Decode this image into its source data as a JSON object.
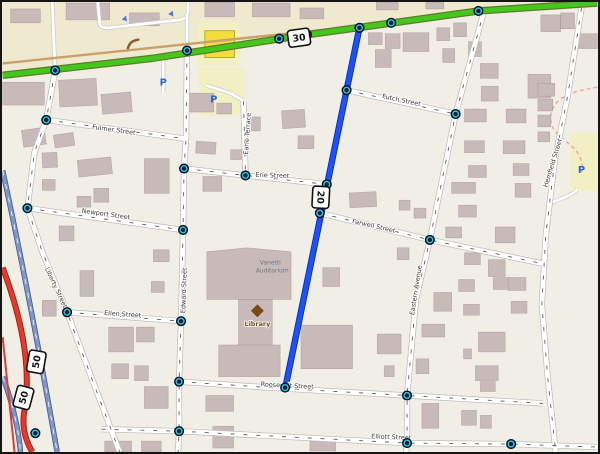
{
  "map": {
    "background": {
      "base": "#f1eee6",
      "upper_band": "#efe9cf"
    },
    "colors": {
      "building": "#c9baba",
      "building_stroke": "#9a8484",
      "road_fill": "#ffffff",
      "road_casing": "#b9b9b9",
      "road_dash": "#5a5a5a",
      "highway_green": "#43c71c",
      "highway_green_casing": "#5d7a28",
      "route_blue": "#1f52f5",
      "route_blue_casing": "#0c2fae",
      "motorway_blue": "#8098c8",
      "motorway_blue_casing": "#4a5a85",
      "trunk_red": "#e13b30",
      "trunk_red_casing": "#9c1a12",
      "tan_road": "#c9a06a",
      "parking_yellow": "#f2efc2",
      "yellow_building": "#f2dd3c",
      "yellow_building_stroke": "#b09a20",
      "parking_letter": "#2a66c8",
      "node_core": "#0c1c2e",
      "node_ring": "#2ec7ea",
      "label": "#3a3a3a",
      "library_brown": "#7a4a14",
      "auditorium_label": "#66788c",
      "pink_dashed": "#f2a8a8",
      "oneway_arrow": "#4a7ae0",
      "hedge_brown": "#8a5a2a"
    },
    "route_shields": [
      {
        "ref": "30",
        "x": 299,
        "y": 36,
        "rot": -8
      },
      {
        "ref": "20",
        "x": 321,
        "y": 197,
        "rot": 93
      },
      {
        "ref": "50",
        "x": 34,
        "y": 363,
        "rot": -80
      },
      {
        "ref": "50",
        "x": 21,
        "y": 399,
        "rot": -75
      }
    ],
    "street_labels": [
      {
        "name": "Fulmer Street",
        "x": 112,
        "y": 131,
        "rot": 8
      },
      {
        "name": "Erie Street",
        "x": 272,
        "y": 177,
        "rot": 2
      },
      {
        "name": "Newport Street",
        "x": 104,
        "y": 216,
        "rot": 8
      },
      {
        "name": "Ellen Street",
        "x": 121,
        "y": 317,
        "rot": 4
      },
      {
        "name": "Liberty Street",
        "x": 52,
        "y": 289,
        "rot": 65
      },
      {
        "name": "Edward Street",
        "x": 185,
        "y": 291,
        "rot": -88
      },
      {
        "name": "Earle Terrace",
        "x": 249,
        "y": 133,
        "rot": -86
      },
      {
        "name": "Futch Street",
        "x": 402,
        "y": 101,
        "rot": 12
      },
      {
        "name": "Farwell Street",
        "x": 374,
        "y": 228,
        "rot": 13
      },
      {
        "name": "Eastern Avenue",
        "x": 419,
        "y": 291,
        "rot": -81
      },
      {
        "name": "Hemfield Street",
        "x": 557,
        "y": 163,
        "rot": -73
      },
      {
        "name": "Roosevelt Street",
        "x": 287,
        "y": 389,
        "rot": 3
      },
      {
        "name": "Elliott Street",
        "x": 392,
        "y": 441,
        "rot": 2
      }
    ],
    "poi": {
      "library_label": "Library",
      "auditorium_line1": "Vanetti",
      "auditorium_line2": "Auditorium",
      "parking_symbol": "P"
    },
    "parking_positions": [
      [
        162,
        81
      ],
      [
        213,
        98
      ],
      [
        584,
        169
      ]
    ],
    "parking_areas": [
      [
        196,
        20,
        44,
        44
      ],
      [
        198,
        66,
        46,
        48
      ],
      [
        573,
        132,
        27,
        58
      ]
    ],
    "yellow_building": [
      204,
      29,
      30,
      27
    ],
    "nodes": [
      [
        53,
        69
      ],
      [
        186,
        49
      ],
      [
        279,
        37
      ],
      [
        307,
        33
      ],
      [
        392,
        21
      ],
      [
        480,
        9
      ],
      [
        360,
        26
      ],
      [
        347,
        89
      ],
      [
        327,
        184
      ],
      [
        320,
        213
      ],
      [
        285,
        389
      ],
      [
        44,
        119
      ],
      [
        25,
        208
      ],
      [
        65,
        313
      ],
      [
        183,
        168
      ],
      [
        182,
        230
      ],
      [
        180,
        322
      ],
      [
        178,
        383
      ],
      [
        178,
        433
      ],
      [
        245,
        175
      ],
      [
        457,
        113
      ],
      [
        431,
        240
      ],
      [
        408,
        397
      ],
      [
        408,
        445
      ],
      [
        513,
        446
      ],
      [
        33,
        435
      ]
    ],
    "buildings": [
      [
        8,
        7,
        30,
        14,
        0
      ],
      [
        64,
        1,
        44,
        17,
        0
      ],
      [
        128,
        11,
        30,
        13,
        0
      ],
      [
        204,
        0,
        30,
        15,
        0
      ],
      [
        252,
        1,
        38,
        14,
        0
      ],
      [
        300,
        6,
        24,
        11,
        0
      ],
      [
        377,
        0,
        22,
        8,
        0
      ],
      [
        427,
        0,
        18,
        7,
        0
      ],
      [
        0,
        81,
        42,
        23,
        0
      ],
      [
        57,
        78,
        38,
        27,
        -3
      ],
      [
        100,
        92,
        30,
        20,
        -5
      ],
      [
        20,
        128,
        23,
        17,
        -8
      ],
      [
        52,
        133,
        20,
        13,
        -8
      ],
      [
        40,
        152,
        15,
        15,
        -3
      ],
      [
        76,
        158,
        34,
        17,
        -6
      ],
      [
        40,
        179,
        13,
        11,
        0
      ],
      [
        92,
        188,
        15,
        14,
        0
      ],
      [
        75,
        196,
        14,
        11,
        0
      ],
      [
        57,
        226,
        15,
        15,
        0
      ],
      [
        78,
        271,
        14,
        26,
        0
      ],
      [
        40,
        301,
        14,
        16,
        0
      ],
      [
        107,
        328,
        25,
        25,
        0
      ],
      [
        135,
        328,
        18,
        15,
        0
      ],
      [
        110,
        365,
        17,
        15,
        0
      ],
      [
        133,
        367,
        14,
        15,
        0
      ],
      [
        143,
        388,
        24,
        22,
        0
      ],
      [
        103,
        443,
        27,
        11,
        0
      ],
      [
        140,
        443,
        20,
        11,
        0
      ],
      [
        143,
        158,
        25,
        35,
        0
      ],
      [
        188,
        92,
        25,
        19,
        0
      ],
      [
        216,
        102,
        15,
        11,
        0
      ],
      [
        246,
        116,
        14,
        14,
        0
      ],
      [
        282,
        109,
        23,
        18,
        -4
      ],
      [
        195,
        141,
        20,
        12,
        4
      ],
      [
        230,
        149,
        14,
        10,
        0
      ],
      [
        202,
        176,
        19,
        15,
        0
      ],
      [
        152,
        250,
        16,
        12,
        0
      ],
      [
        150,
        282,
        13,
        11,
        0
      ],
      [
        298,
        135,
        16,
        13,
        0
      ],
      [
        205,
        397,
        28,
        16,
        0
      ],
      [
        212,
        428,
        21,
        22,
        0
      ],
      [
        310,
        443,
        26,
        10,
        0
      ],
      [
        369,
        31,
        14,
        12,
        0
      ],
      [
        386,
        32,
        15,
        15,
        0
      ],
      [
        404,
        31,
        26,
        19,
        0
      ],
      [
        438,
        26,
        13,
        13,
        0
      ],
      [
        455,
        21,
        13,
        14,
        0
      ],
      [
        376,
        48,
        16,
        18,
        0
      ],
      [
        444,
        47,
        12,
        14,
        0
      ],
      [
        470,
        40,
        13,
        15,
        0
      ],
      [
        482,
        62,
        18,
        15,
        0
      ],
      [
        483,
        85,
        17,
        15,
        0
      ],
      [
        530,
        73,
        23,
        24,
        0
      ],
      [
        543,
        13,
        20,
        17,
        0
      ],
      [
        563,
        11,
        14,
        16,
        0
      ],
      [
        580,
        32,
        20,
        15,
        0
      ],
      [
        350,
        192,
        27,
        15,
        -3
      ],
      [
        400,
        200,
        11,
        10,
        0
      ],
      [
        415,
        208,
        12,
        10,
        0
      ],
      [
        398,
        248,
        12,
        12,
        0
      ],
      [
        453,
        182,
        24,
        11,
        0
      ],
      [
        517,
        183,
        16,
        14,
        0
      ],
      [
        447,
        227,
        16,
        11,
        0
      ],
      [
        497,
        227,
        20,
        16,
        0
      ],
      [
        490,
        260,
        17,
        17,
        0
      ],
      [
        495,
        278,
        18,
        12,
        0
      ],
      [
        466,
        108,
        22,
        13,
        0
      ],
      [
        508,
        108,
        20,
        14,
        0
      ],
      [
        466,
        140,
        20,
        12,
        0
      ],
      [
        505,
        140,
        22,
        13,
        0
      ],
      [
        470,
        165,
        18,
        12,
        0
      ],
      [
        515,
        163,
        16,
        12,
        0
      ],
      [
        460,
        205,
        18,
        12,
        0
      ],
      [
        466,
        253,
        16,
        12,
        0
      ],
      [
        460,
        280,
        16,
        12,
        0
      ],
      [
        510,
        278,
        18,
        13,
        0
      ],
      [
        465,
        305,
        16,
        11,
        0
      ],
      [
        513,
        302,
        16,
        12,
        0
      ],
      [
        323,
        268,
        17,
        19,
        0
      ],
      [
        301,
        326,
        52,
        44,
        0
      ],
      [
        378,
        335,
        24,
        20,
        0
      ],
      [
        385,
        367,
        10,
        11,
        0
      ],
      [
        423,
        325,
        23,
        13,
        0
      ],
      [
        417,
        360,
        13,
        15,
        0
      ],
      [
        423,
        405,
        17,
        25,
        0
      ],
      [
        480,
        333,
        27,
        20,
        0
      ],
      [
        477,
        367,
        23,
        15,
        0
      ],
      [
        482,
        383,
        15,
        10,
        0
      ],
      [
        463,
        412,
        15,
        15,
        0
      ],
      [
        482,
        417,
        11,
        13,
        0
      ],
      [
        465,
        350,
        8,
        10,
        0
      ],
      [
        435,
        293,
        18,
        19,
        0
      ],
      [
        540,
        82,
        17,
        13,
        0
      ],
      [
        540,
        98,
        15,
        12,
        0
      ],
      [
        540,
        114,
        13,
        12,
        0
      ],
      [
        540,
        131,
        12,
        10,
        0
      ]
    ],
    "auditorium_shapes": [
      "M206,252 L246,248 L291,252 L291,300 L206,300 Z",
      "M238,300 L272,300 L272,348 L238,348 Z",
      "M218,346 L280,346 L280,378 L218,378 Z"
    ]
  }
}
